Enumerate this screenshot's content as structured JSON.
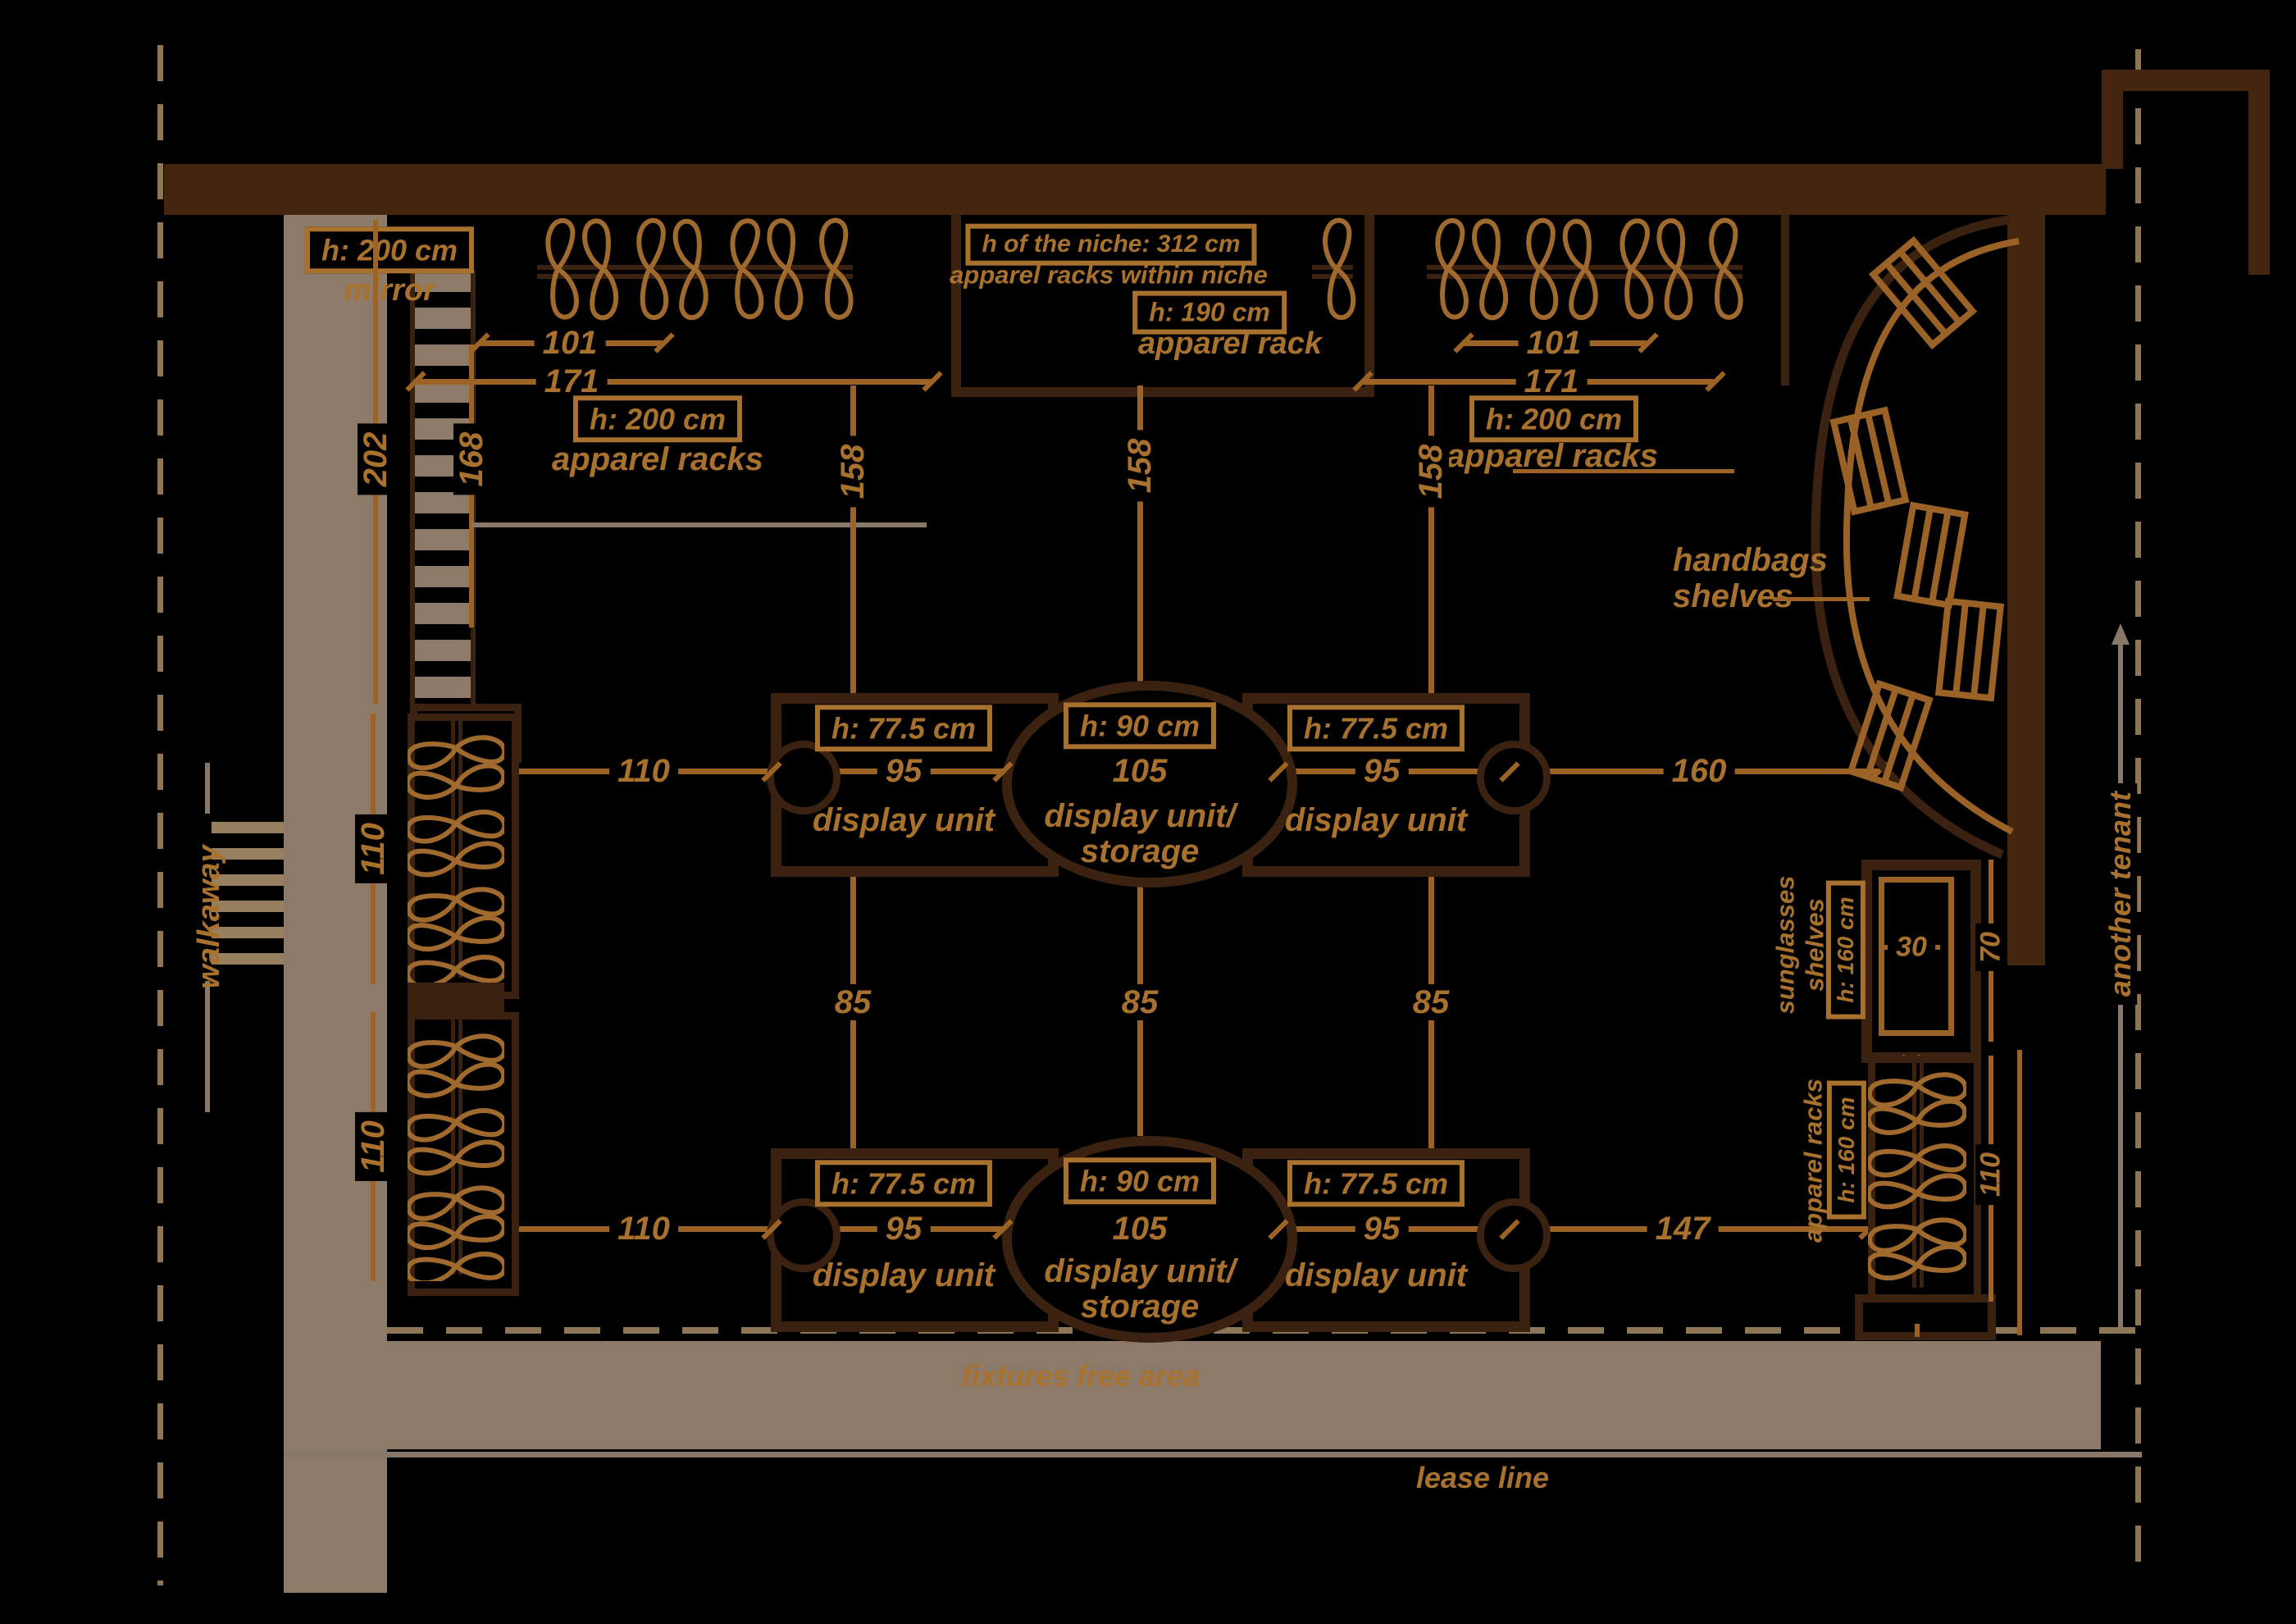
{
  "colors": {
    "background": "#000000",
    "wall": "#44260f",
    "fixture": "#3a2110",
    "accent": "#9c6325",
    "text": "#a8722e",
    "tan_floor": "#8d7a68",
    "gray_line": "#87786a"
  },
  "mirror": {
    "h_label": "h: 200 cm",
    "name": "mirror",
    "dim_outer": "202",
    "dim_inner": "168"
  },
  "walkway_label": "walkaway",
  "boundary": {
    "another_tenant": "another tenant",
    "lease_line": "lease line",
    "fixtures_free": "fixtures free area"
  },
  "drop_dim": "158",
  "aisle_dim": "85",
  "top_left_rack": {
    "width_dim": "101",
    "total_dim": "171",
    "height_label": "h: 200 cm",
    "name": "apparel racks"
  },
  "top_right_rack": {
    "width_dim": "101",
    "total_dim": "171",
    "height_label": "h: 200 cm",
    "name": "apparel racks"
  },
  "niche": {
    "height_label": "h of the niche: 312 cm",
    "name": "apparel racks within niche",
    "rack_height_label": "h: 190 cm",
    "rack_name": "apparel rack"
  },
  "display_rows": [
    {
      "left_dim": "110",
      "right_dim": "160",
      "units": [
        {
          "height_label": "h: 77.5 cm",
          "width_dim": "95",
          "name": "display unit"
        },
        {
          "height_label": "h: 90 cm",
          "width_dim": "105",
          "name": "display unit/",
          "name2": "storage"
        },
        {
          "height_label": "h: 77.5 cm",
          "width_dim": "95",
          "name": "display unit"
        }
      ]
    },
    {
      "left_dim": "110",
      "right_dim": "147",
      "units": [
        {
          "height_label": "h: 77.5 cm",
          "width_dim": "95",
          "name": "display unit"
        },
        {
          "height_label": "h: 90 cm",
          "width_dim": "105",
          "name": "display unit/",
          "name2": "storage"
        },
        {
          "height_label": "h: 77.5 cm",
          "width_dim": "95",
          "name": "display unit"
        }
      ]
    }
  ],
  "left_racks": {
    "dim1": "110",
    "dim2": "110"
  },
  "handbags": {
    "line1": "handbags",
    "line2": "shelves"
  },
  "sunglasses": {
    "line1": "sunglasses",
    "line2": "shelves",
    "height_label": "h: 160 cm",
    "width_dim": "30",
    "depth_dim": "70"
  },
  "right_rack": {
    "name": "apparel racks",
    "height_label": "h: 160 cm",
    "dim": "110"
  }
}
